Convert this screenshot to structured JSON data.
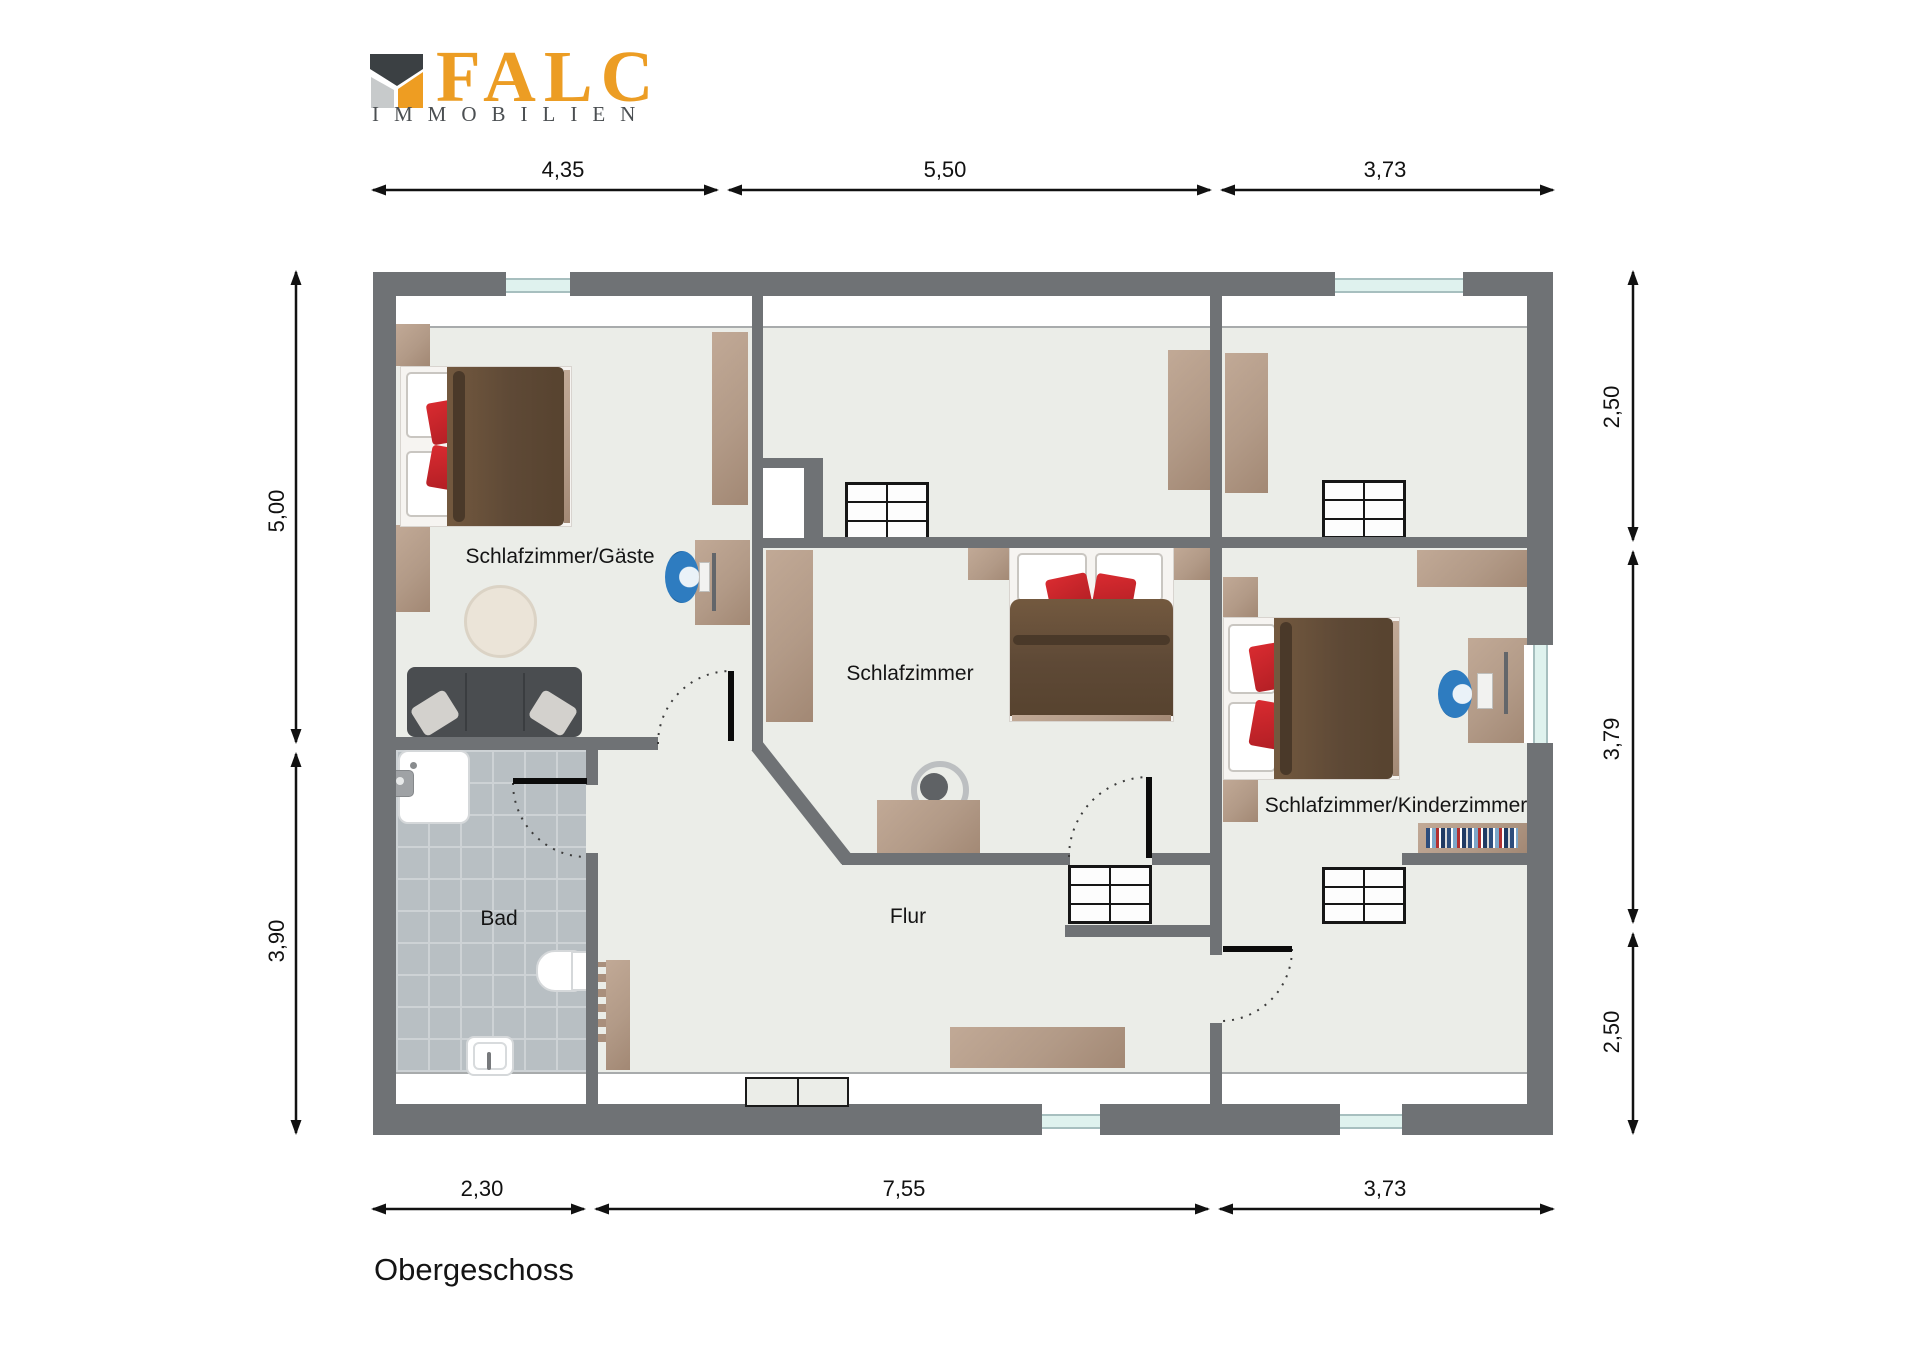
{
  "logo": {
    "brand": "FALC",
    "subtitle": "IMMOBILIEN"
  },
  "floor_title": "Obergeschoss",
  "rooms": [
    {
      "id": "schlafzimmer-gaeste",
      "label": "Schlafzimmer/Gäste"
    },
    {
      "id": "schlafzimmer",
      "label": "Schlafzimmer"
    },
    {
      "id": "schlafzimmer-kinderzimmer",
      "label": "Schlafzimmer/Kinderzimmer"
    },
    {
      "id": "bad",
      "label": "Bad"
    },
    {
      "id": "flur",
      "label": "Flur"
    }
  ],
  "dimensions": {
    "top": [
      "4,35",
      "5,50",
      "3,73"
    ],
    "bottom": [
      "2,30",
      "7,55",
      "3,73"
    ],
    "left": [
      "5,00",
      "3,90"
    ],
    "right": [
      "2,50",
      "3,79",
      "2,50"
    ]
  },
  "colors": {
    "wall": "#6f7275",
    "floor": "#ebede8",
    "bath_tile": "#b8bfc3",
    "wood": "#b29a87",
    "bed_brown": "#5e4936",
    "pillow_red": "#c5242a",
    "chair_blue": "#2e7cc0",
    "window_glass": "#dff2ee",
    "logo_orange": "#ec9d24",
    "logo_dark": "#3b4043",
    "logo_light": "#c7cacb"
  }
}
